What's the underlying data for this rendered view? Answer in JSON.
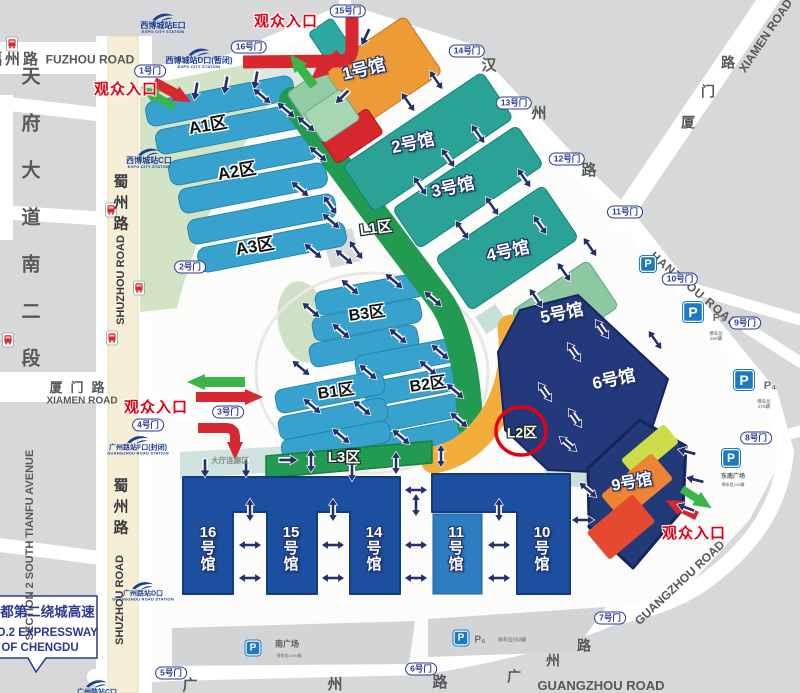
{
  "colors": {
    "entrance_red": "#e60012",
    "route_red": "#d7282f",
    "route_green": "#3bb44a",
    "hall_teal": "#2aa296",
    "hall_orange": "#ec9b36",
    "hall_lightgreen": "#8cc9a3",
    "hall_navy": "#24397b",
    "hall_blue": "#1c4fa0",
    "hall_mediumblue": "#2e7dc0",
    "zone_bar_blue": "#36a2cd",
    "l_zone_green": "#229a52",
    "band_orange": "#f2ad3b",
    "hall9_lime": "#cddd49",
    "hall9_orange": "#ef8534",
    "hall9_red": "#e5492f",
    "road_cream": "#f6efd8",
    "park_green": "#d2e3c6",
    "gate_navy": "#2b3990",
    "metro_navy": "#1c3f94",
    "parking_blue": "#1b7ac2"
  },
  "entrance_label": "观众入口",
  "halls": {
    "h1": "1号馆",
    "h2": "2号馆",
    "h3": "3号馆",
    "h4": "4号馆",
    "h5": "5号馆",
    "h6": "6号馆",
    "h9": "9号馆",
    "h10": "10\n号\n馆",
    "h11": "11\n号\n馆",
    "h14": "14\n号\n馆",
    "h15": "15\n号\n馆",
    "h16": "16\n号\n馆"
  },
  "zones": {
    "a1": "A1区",
    "a2": "A2区",
    "a3": "A3区",
    "b1": "B1区",
    "b2": "B2区",
    "b3": "B3区",
    "l1": "L1区",
    "l2": "L2区",
    "l3": "L3区",
    "lobby": "大厅连廊区"
  },
  "gates": {
    "g1": "1号门",
    "g2": "2号门",
    "g3": "3号门",
    "g4": "4号门",
    "g5": "5号门",
    "g6": "6号门",
    "g7": "7号门",
    "g8": "8号门",
    "g9": "9号门",
    "g10": "10号门",
    "g11": "11号门",
    "g12": "12号门",
    "g13": "13号门",
    "g14": "14号门",
    "g15": "15号门",
    "g16": "16号门"
  },
  "roads": {
    "fuzhou_cn": "福州路",
    "fuzhou_en": "FUZHOU ROAD",
    "tianfu_cn": "天\n府\n大\n道\n南\n二\n段",
    "tianfu_en": "SECTION 2 SOUTH TIANFU AVENUE",
    "shuzhou_cn": "蜀\n州\n路",
    "shuzhou_en": "SHUZHOU ROAD",
    "xiamen_cn": "厦门路",
    "xiamen_en": "XIAMEN ROAD",
    "xiamen_chars": [
      "厦",
      "门",
      "路"
    ],
    "hanzhou_chars": [
      "汉",
      "州",
      "路"
    ],
    "hanzhou_en": "HANZHOU ROAD",
    "guangzhou_chars": [
      "广",
      "州",
      "路"
    ],
    "guangzhou_en": "GUANGZHOU ROAD"
  },
  "metro": {
    "e_name": "西博城站E口",
    "d_name": "西博城站D口(暂闭)",
    "c_name": "西博城站C口",
    "expo_station": "EXPO CITY STATION",
    "gf_name": "广州路站F口(封闭)",
    "gd_name": "广州路站D口",
    "gc_name": "广州路站C口",
    "guangzhou_station": "GUANGZHOU ROAD STATION"
  },
  "parking": {
    "p": "P",
    "p3": "P₃",
    "p3_note": "停车位\n260辆",
    "p4": "P₄",
    "p4_note": "停车位\n279辆",
    "p5": "P₅",
    "p5_note": "停车位550辆",
    "south_plaza": "南广场",
    "south_note": "停车位1200辆",
    "se_plaza": "东南广场",
    "se_note": "停车位210辆"
  },
  "sign": {
    "line1": "至成都第二绕城高速",
    "line2": "NO.2 EXPRESSWAY",
    "line3": "OF CHENGDU"
  }
}
